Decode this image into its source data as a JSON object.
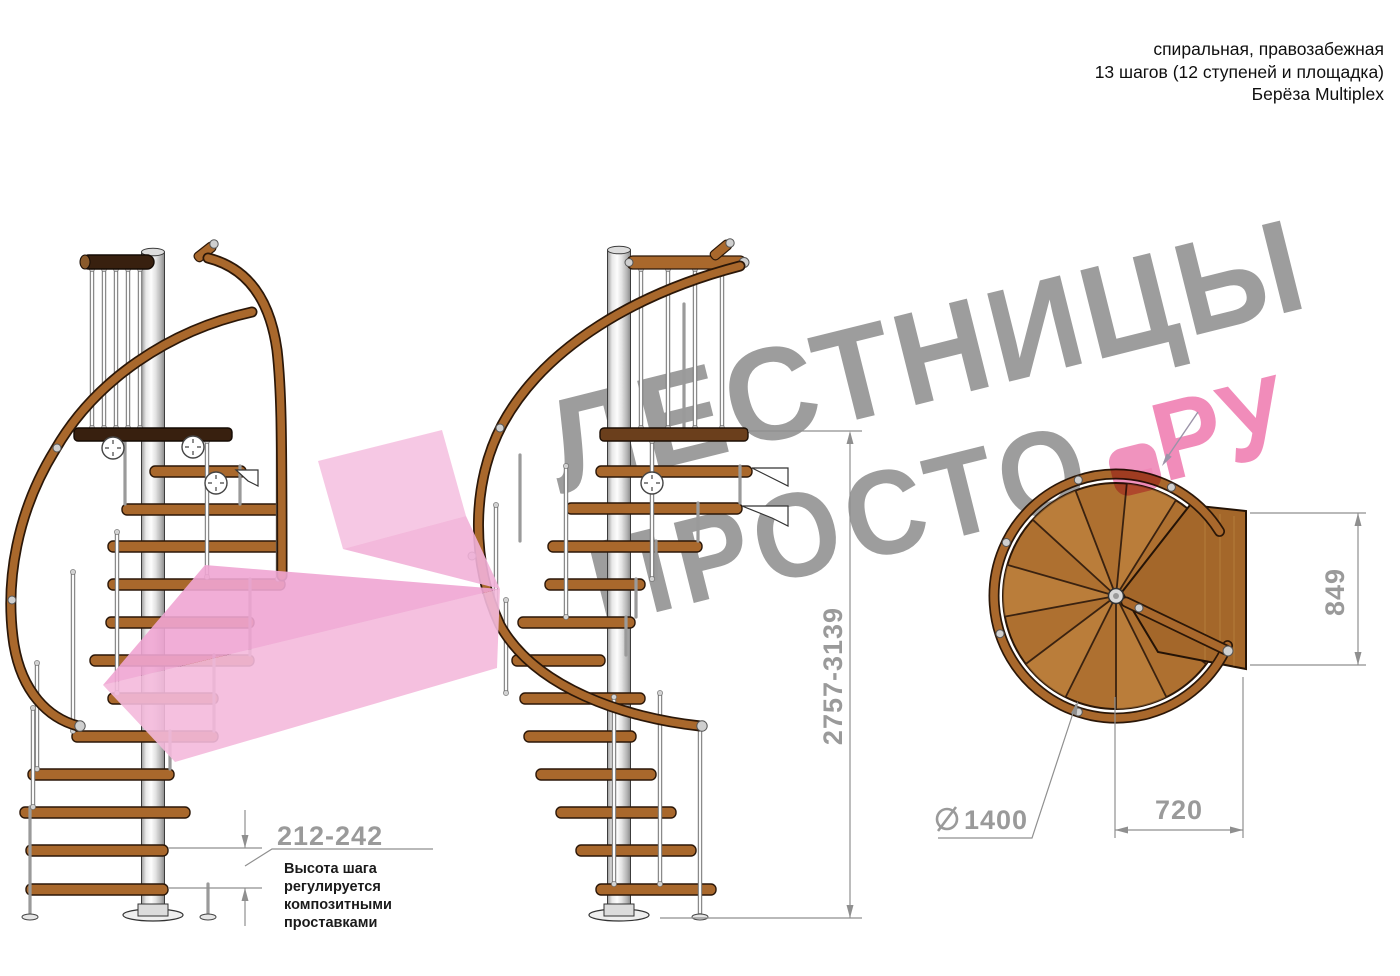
{
  "title_block": {
    "line1": "спиральная, правозабежная",
    "line2": "13 шагов (12 ступеней и площадка)",
    "line3": "Берёза Multiplex"
  },
  "watermark": {
    "word1": "ЛЕСТНИЦЫ",
    "word2": "ПРОСТО",
    "word2_suffix": ".РУ",
    "gray_color": "#9d9d9d",
    "pink_color": "#f18cba"
  },
  "dimensions": {
    "step_height_label": "212-242",
    "step_height_note_lines": [
      "Высота шага",
      "регулируется",
      "композитными",
      "проставками"
    ],
    "total_height_label": "2757-3139",
    "plan_depth_label": "849",
    "plan_width_label": "720",
    "diameter_symbol": "⌀",
    "plan_diameter_label": "1400"
  },
  "colors": {
    "wood": "#a9682c",
    "wood_outline": "#2b1708",
    "plan_wood": "#ae7030",
    "plan_wood_light": "#c68a44",
    "platform_wood": "#a4672a",
    "dark_board": "#38200f",
    "dimension_line": "#8f8f8f",
    "dimension_text": "#9a9a9a",
    "arrow_pink_light": "#f6c3e1",
    "arrow_pink": "#f0a6d3",
    "dot_pink": "#ef87b7"
  }
}
